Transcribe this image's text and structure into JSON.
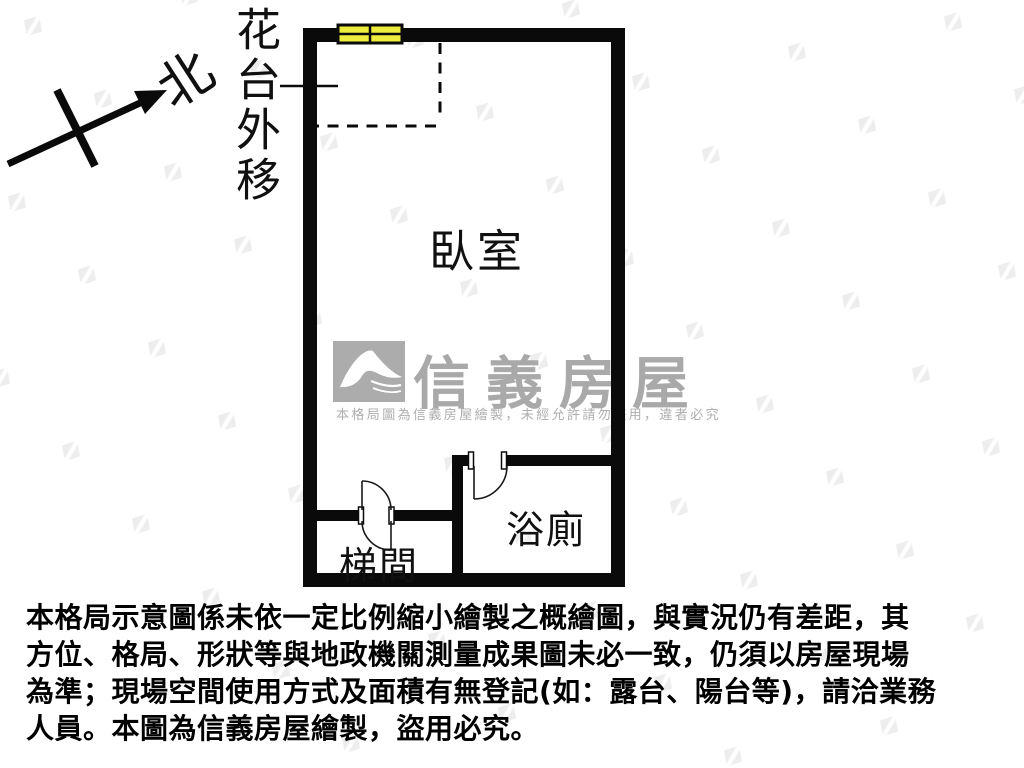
{
  "north_indicator": {
    "label": "北"
  },
  "annotations": {
    "flower_terrace": "花台外移"
  },
  "rooms": {
    "bedroom": "臥室",
    "bathroom": "浴廁",
    "stairwell": "梯間"
  },
  "watermark": {
    "brand": "信義房屋",
    "notice": "本格局圖為信義房屋繪製，未經允許請勿盜用，違者必究"
  },
  "disclaimer": {
    "lines": [
      "本格局示意圖係未依一定比例縮小繪製之概繪圖，與實況仍有差距，其",
      "方位、格局、形狀等與地政機關測量成果圖未必一致，仍須以房屋現場",
      "為準；現場空間使用方式及面積有無登記(如：露台、陽台等)，請洽業務",
      "人員。本圖為信義房屋繪製，盜用必究。"
    ]
  },
  "colors": {
    "wall": "#0a0a0a",
    "window_fill": "#ecec3c",
    "brand_gray": "#a9a9a9"
  }
}
